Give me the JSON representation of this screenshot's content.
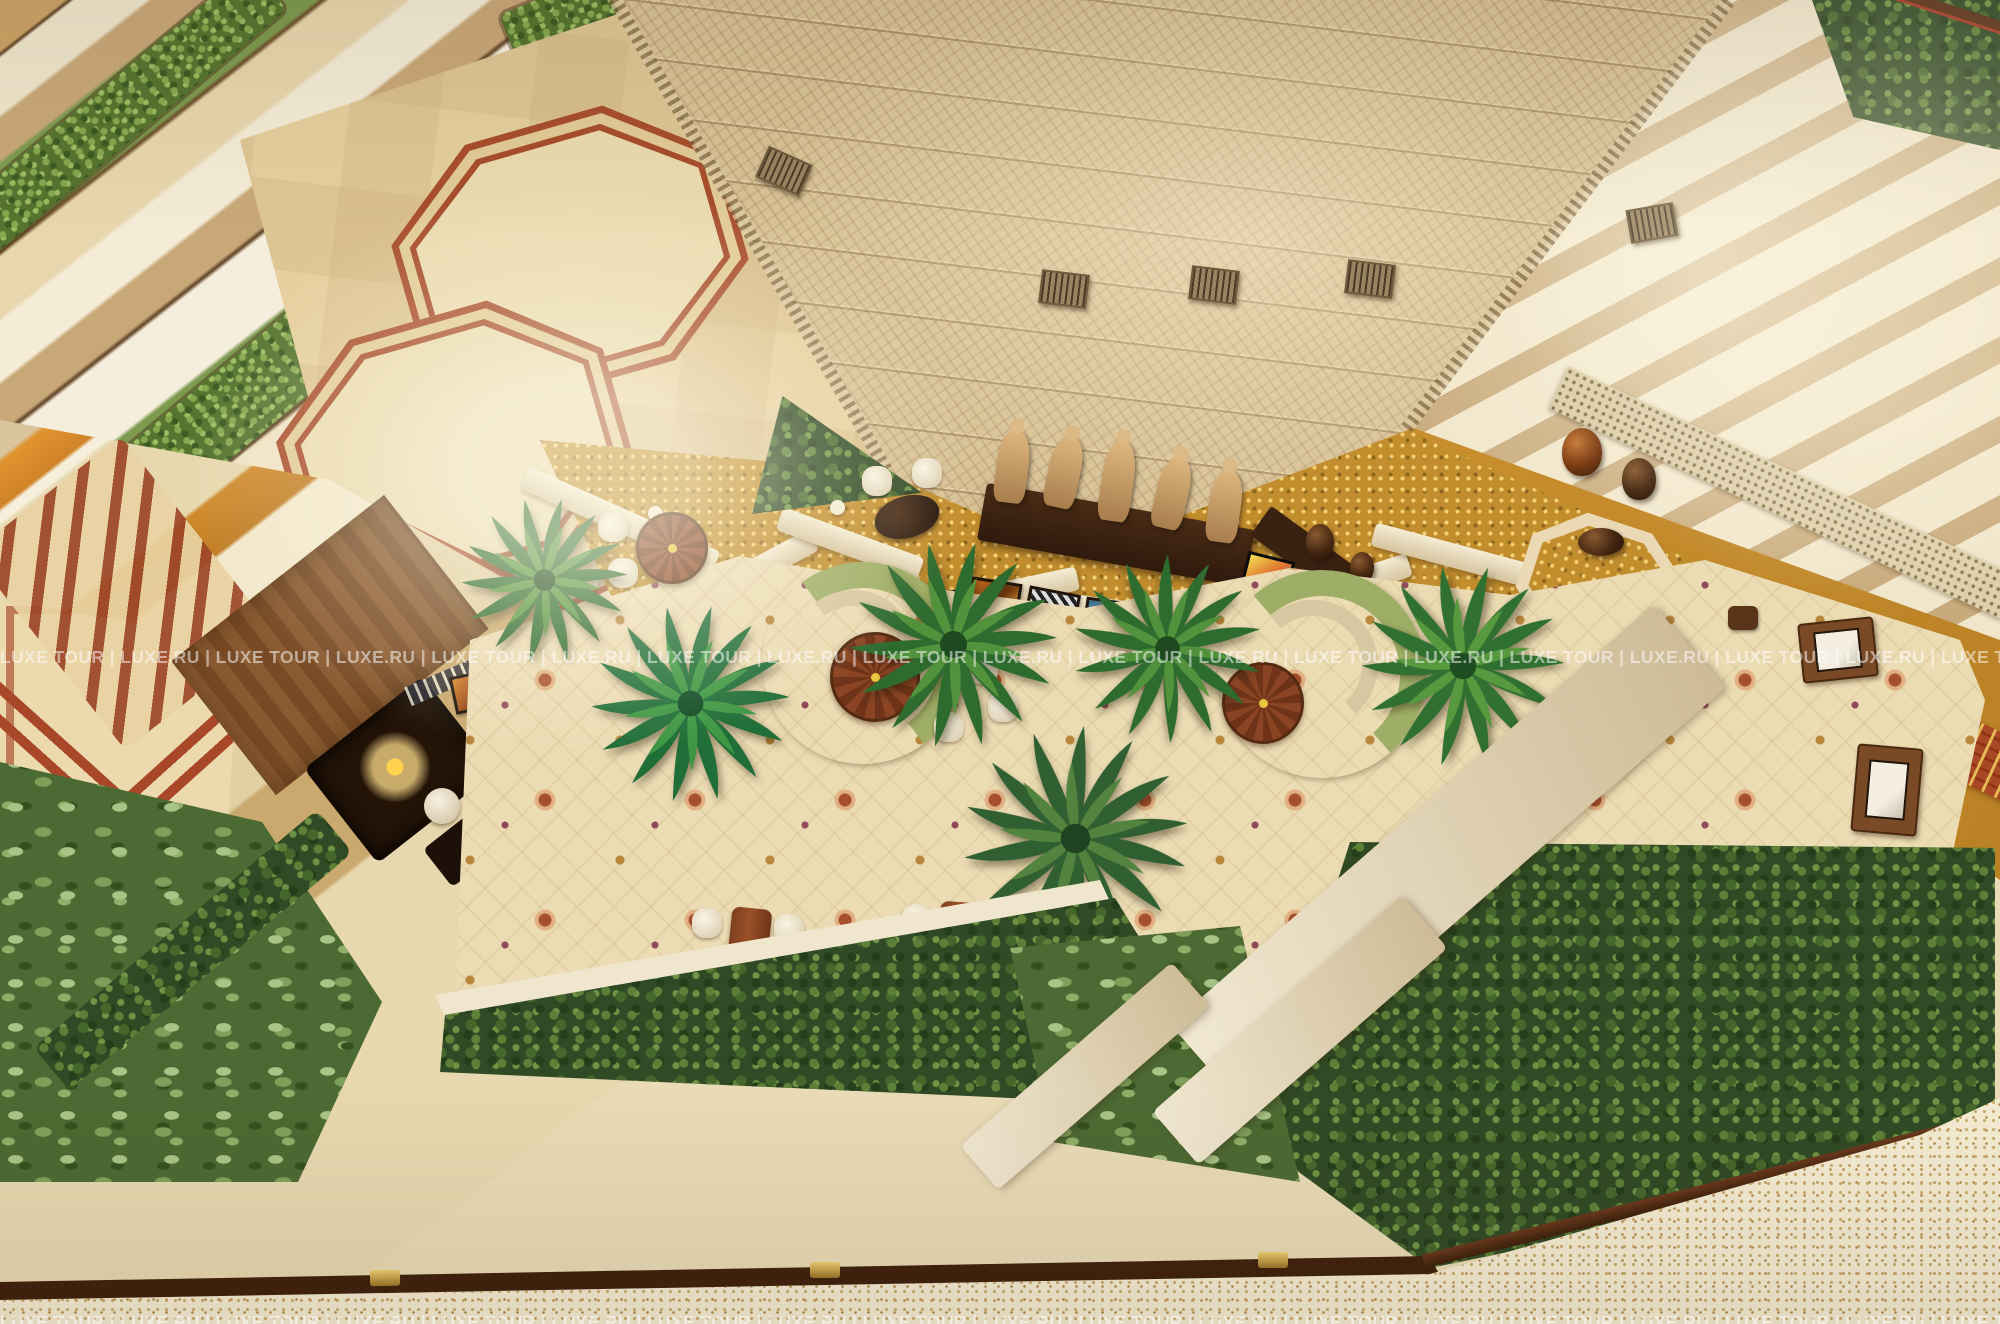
{
  "image": {
    "kind": "aerial-photograph",
    "subject": "Hotel atrium lobby seen from a high balcony, top-down",
    "width_px": 2000,
    "height_px": 1324
  },
  "watermark": {
    "segment": "LUXE TOUR | LUXE.RU",
    "line": "LUXE TOUR | LUXE.RU | LUXE TOUR | LUXE.RU | LUXE TOUR | LUXE.RU | LUXE TOUR | LUXE.RU | LUXE TOUR | LUXE.RU | LUXE TOUR | LUXE.RU | LUXE TOUR | LUXE.RU | LUXE TOUR | LUXE.RU | LUXE TOUR | LUXE.RU | LUXE TOUR | LUXE.RU | LUXE TOUR | LUXE.RU | LUXE TOUR | LUXE.RU |",
    "color": "#ffffff"
  },
  "scene": {
    "statues_count": 5,
    "framed_artworks_under_console": 5,
    "green_curved_sofas": 2,
    "round_wood_tables": 3,
    "rectangular_dining_tables": 2,
    "palm_plants": 6,
    "vent_boxes_on_walls": 5,
    "objects": [
      "herringbone-stone-tower",
      "balcony-planters",
      "octagon-marble-floor",
      "gold-mosaic-floor",
      "carved-wood-statues",
      "floral-carpet",
      "green-curved-sofa",
      "palm-plants",
      "hedge-planters",
      "display-cases",
      "easel-artworks",
      "wood-handrail",
      "terrazzo-floor",
      "wrought-iron-scroll-railing",
      "urns-and-vases"
    ]
  },
  "colors": {
    "cream": "#e9dbb6",
    "stone": "#e6d8b4",
    "tan": "#c9a878",
    "goldfloor": "#c28d2d",
    "carpet": "#ecdcb4",
    "carpet-red": "#a7502c",
    "hedge": "#2f4a24",
    "leafy-light": "#a9c487",
    "sofa": "#9fae66",
    "wood": "#7e3f20",
    "wood-dark": "#3a2212",
    "rail-brown": "#5a2e16",
    "marble-red": "#a84e2c",
    "brass": "#e8c558"
  }
}
